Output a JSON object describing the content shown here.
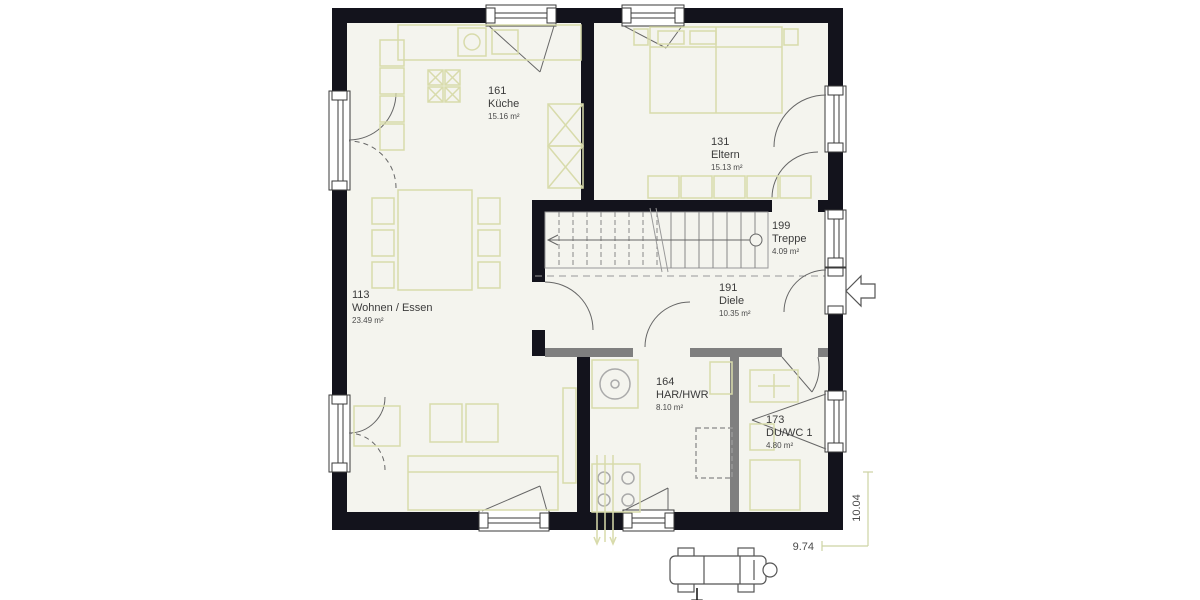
{
  "rooms": [
    {
      "number": "161",
      "name": "Küche",
      "area": "15.16 m²"
    },
    {
      "number": "131",
      "name": "Eltern",
      "area": "15.13 m²"
    },
    {
      "number": "199",
      "name": "Treppe",
      "area": "4.09 m²"
    },
    {
      "number": "113",
      "name": "Wohnen / Essen",
      "area": "23.49 m²"
    },
    {
      "number": "191",
      "name": "Diele",
      "area": "10.35 m²"
    },
    {
      "number": "164",
      "name": "HAR/HWR",
      "area": "8.10 m²"
    },
    {
      "number": "173",
      "name": "DU/WC 1",
      "area": "4.80 m²"
    }
  ],
  "dimensions": {
    "width": "9.74",
    "height": "10.04"
  },
  "colors": {
    "wall": "#13131c",
    "floor": "#f4f4ee",
    "interior_wall": "#7f7f7f",
    "furniture": "#d8dbab",
    "dimension_line": "#cdd3a4"
  }
}
